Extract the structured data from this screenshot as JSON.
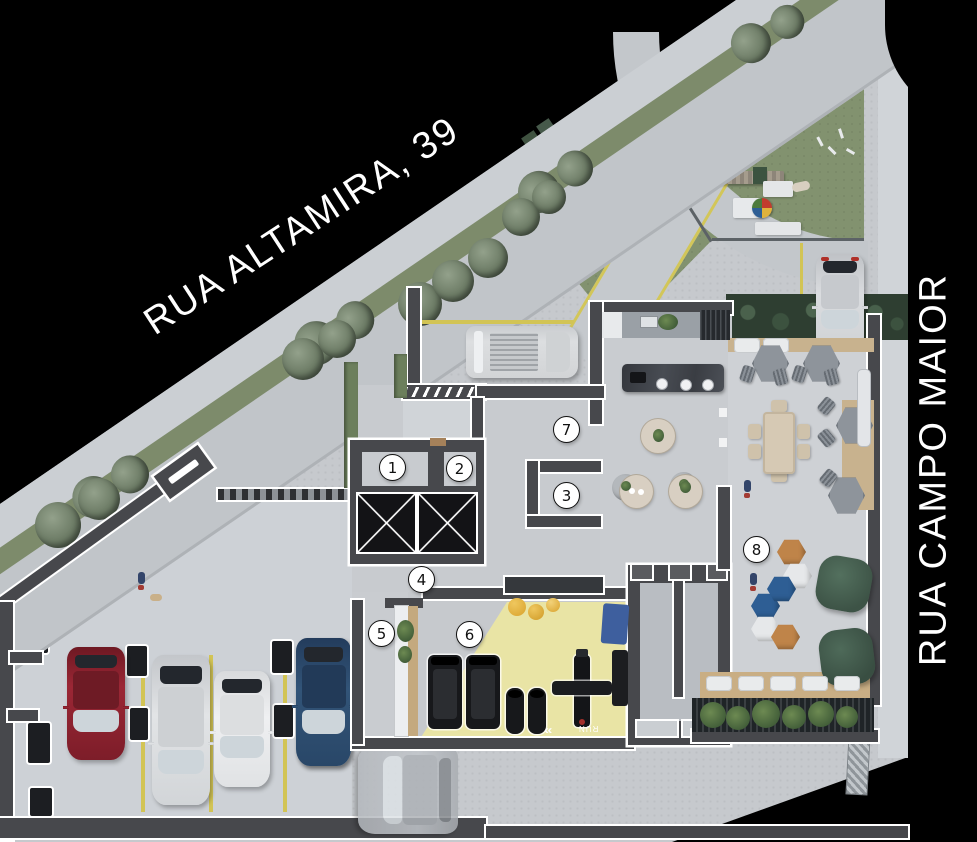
{
  "scene_title": "Ground floor implantation plan",
  "streets": {
    "altamira": {
      "label": "RUA ALTAMIRA, 39"
    },
    "campo_maior": {
      "label": "RUA CAMPO MAIOR"
    }
  },
  "markers": [
    {
      "label": "1"
    },
    {
      "label": "2"
    },
    {
      "label": "3"
    },
    {
      "label": "4"
    },
    {
      "label": "5"
    },
    {
      "label": "6"
    },
    {
      "label": "7"
    },
    {
      "label": "8"
    }
  ],
  "labels": {
    "gym_floor_print": "RUN"
  },
  "colors": {
    "background": "#000000",
    "asphalt": "#c1c5c9",
    "sidewalk": "#cbcfd3",
    "lot_concrete": "#c6c9cd",
    "lawn": "#82926f",
    "gym_floor_yellow": "#e9e4a5",
    "parking_line_yellow": "#d2c455",
    "wall_dark": "#47484c",
    "wall_outline": "#ffffff",
    "pouf_orange": "#bf8449",
    "pouf_blue": "#2e5e94",
    "pouf_white": "#e6e8ea",
    "beanbag_green": "#465f50",
    "car_red": "#8e2230",
    "car_silver": "#d7d9dc",
    "car_white": "#e9ebed",
    "car_blue": "#2d4a6e",
    "deck_wood": "#c8b28e"
  }
}
